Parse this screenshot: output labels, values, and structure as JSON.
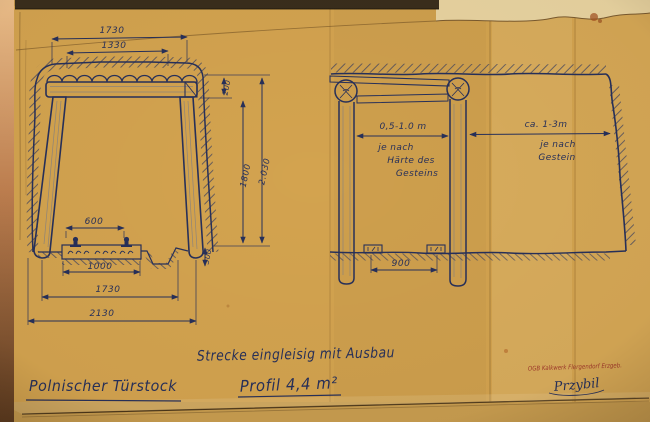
{
  "document": {
    "kind": "scanned mining technical drawing",
    "title": "Polnischer Türstock",
    "caption_line1": "Strecke eingleisig mit Ausbau",
    "caption_line2": "Profil 4,4 m²"
  },
  "left_drawing": {
    "name": "cross-section of timbered gallery",
    "dims": {
      "top_outer": "1730",
      "top_inner": "1330",
      "cap_height": "200",
      "clear_height": "1800",
      "total_height": "2.030",
      "rail_gauge": "600",
      "sleeper_width": "1000",
      "bottom_inner": "1730",
      "bottom_outer": "2130",
      "ditch_depth": "300"
    }
  },
  "right_drawing": {
    "name": "longitudinal section with supports",
    "dims": {
      "frame_spacing": "0,5-1.0 m",
      "spacing_note_1": "je nach",
      "spacing_note_2": "Härte des",
      "spacing_note_3": "Gesteins",
      "advance": "ca. 1-3m",
      "advance_note_1": "je nach",
      "advance_note_2": "Gestein",
      "rail_spacing": "900"
    }
  },
  "stamp": {
    "text": "OGB Kalkwerk Flergendorf Erzgeb.",
    "signature": "Przybil"
  },
  "colors": {
    "paper": "#d3a34f",
    "ink": "#27305a",
    "stamp_red": "#9e372a",
    "top_band": "#3a2e1c"
  }
}
